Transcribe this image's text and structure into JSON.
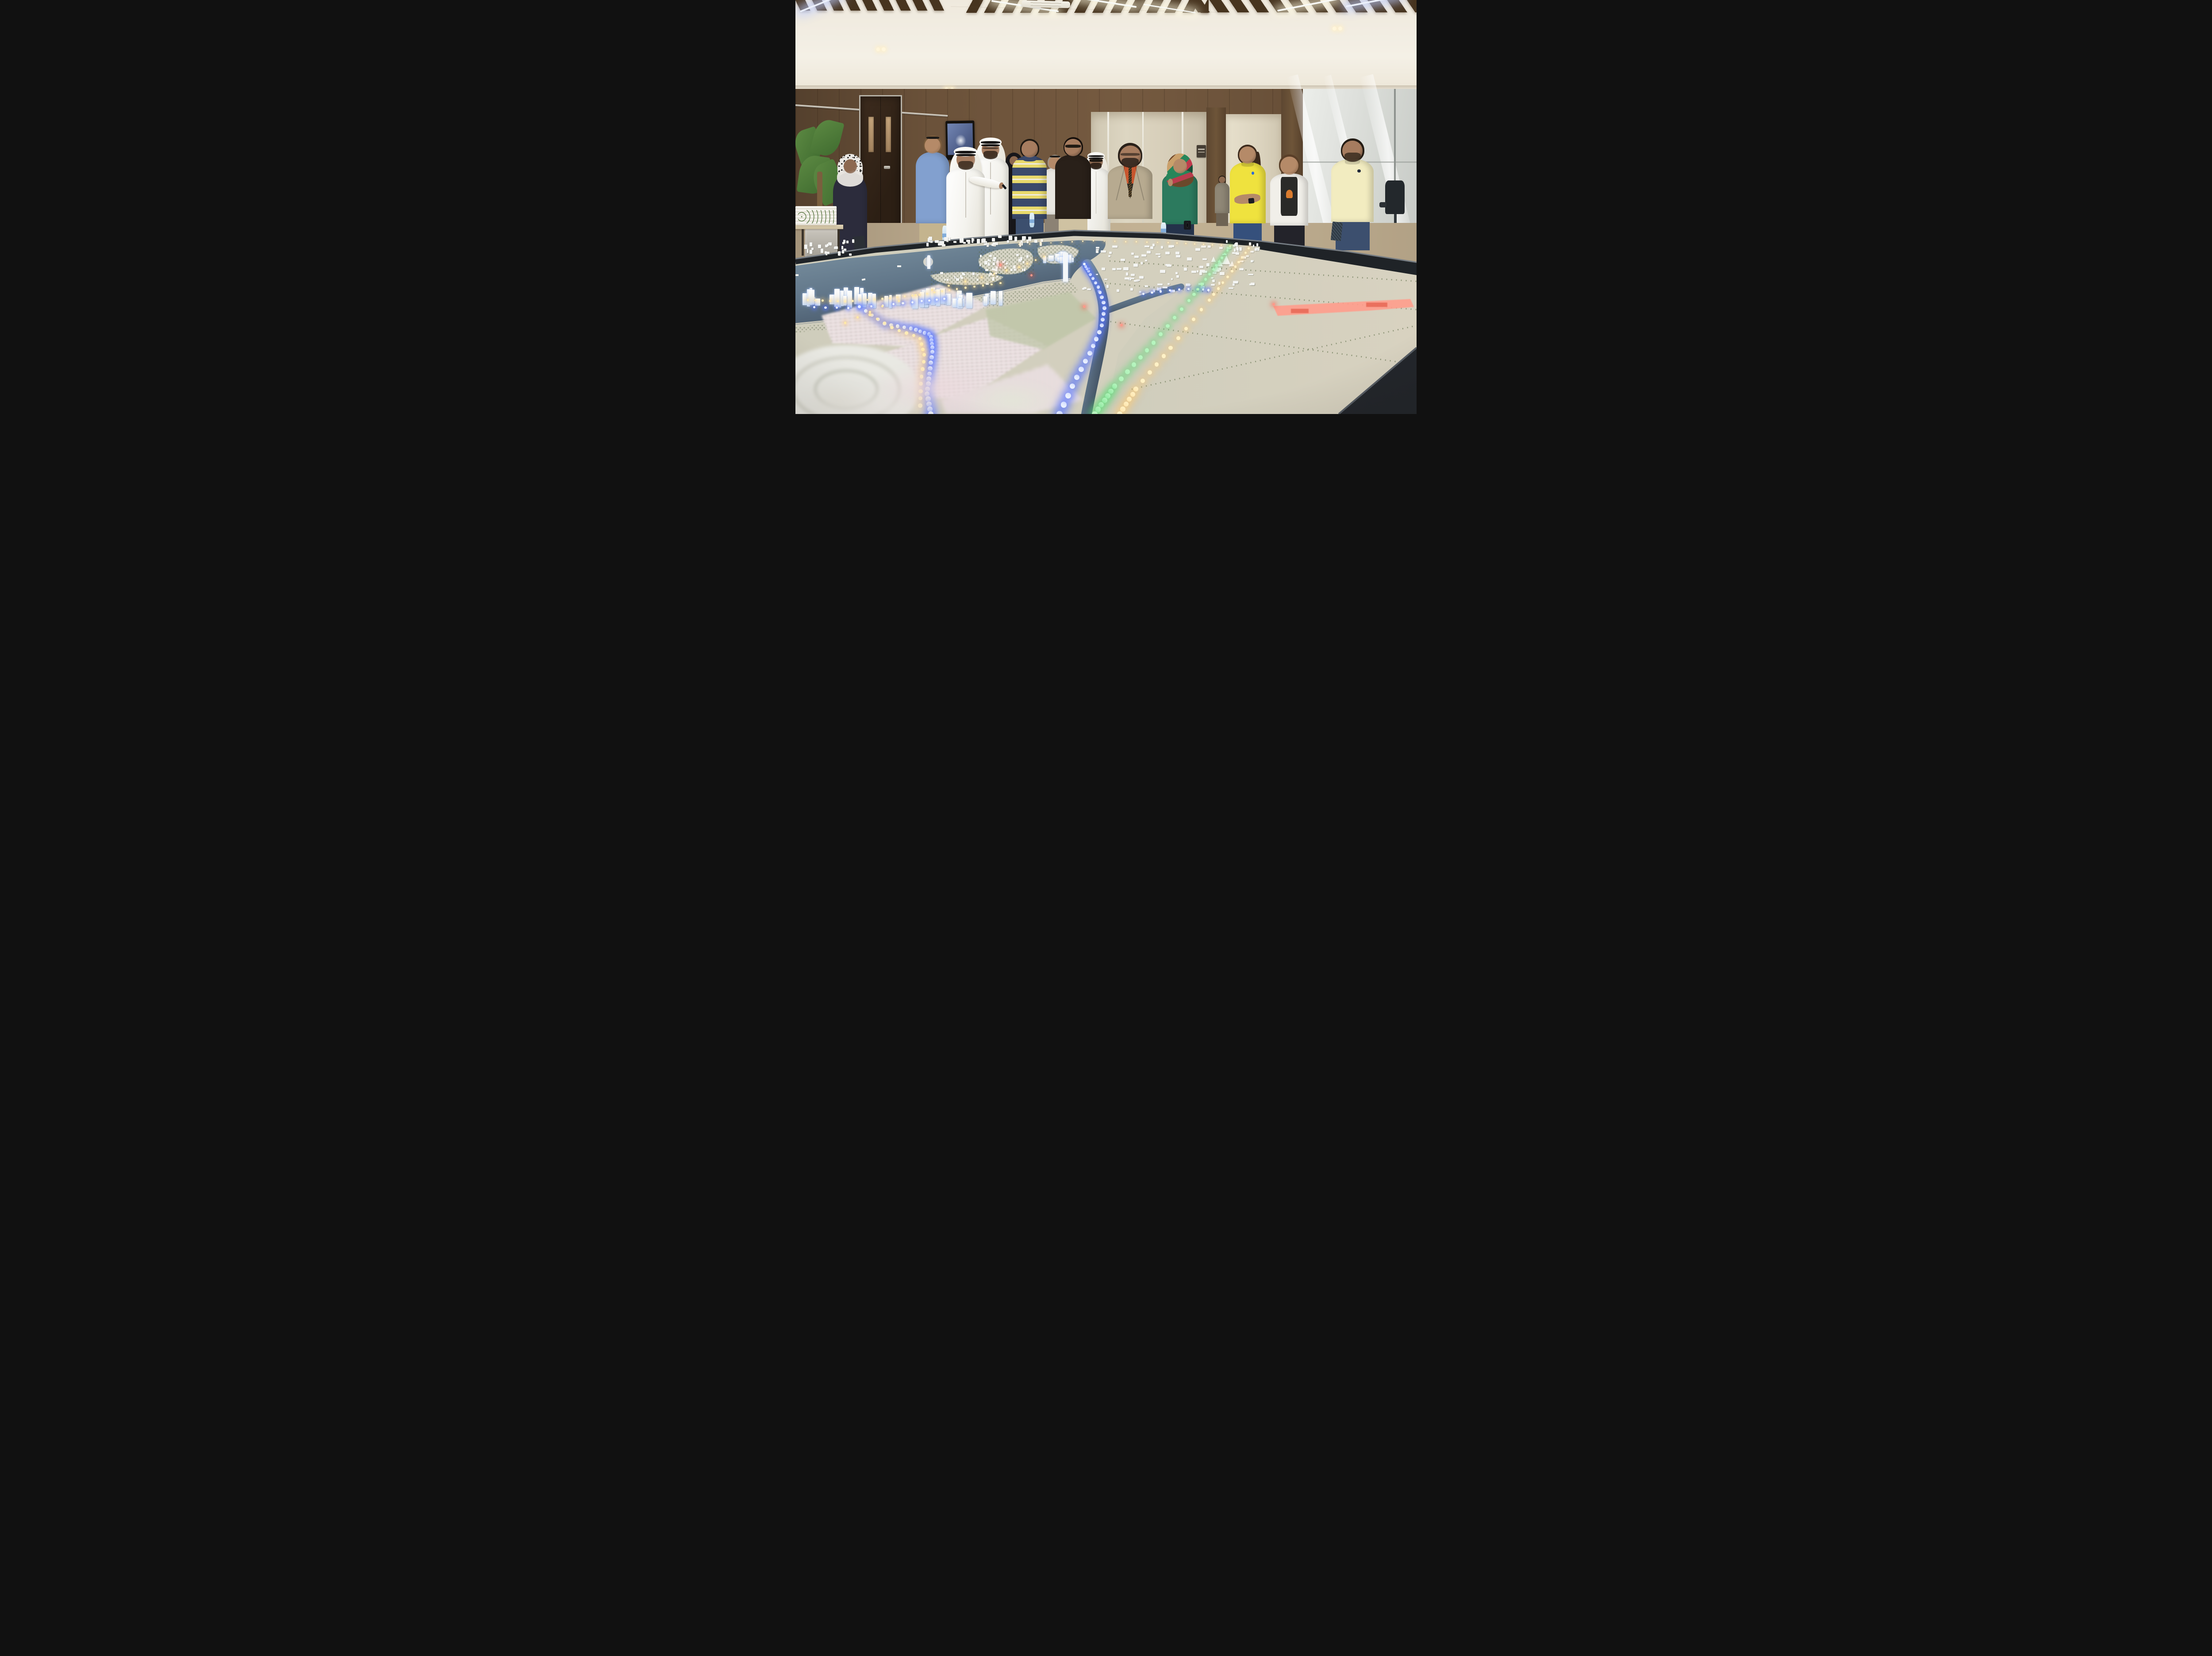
{
  "scene": {
    "label": "Showroom with visitors viewing an illuminated city masterplan scale model",
    "room": "wood-panelled hall with slatted timber ceiling, recessed strip lights, AC cassette, wall TV, double door, glass meeting room",
    "model": "large table model: sea with islands, lit tower skyline, villa districts, desert plain, LED-lit roads (blue, green, warm white), red-lit industrial strip, stadium"
  },
  "colors": {
    "ceiling": "#f1ece2",
    "beam": "#47341f",
    "wood": "#6b523a",
    "door": "#33241a",
    "chrome": "#cfc8bb",
    "floor": "#b3a384",
    "water": "#5f7487",
    "waterDeep": "#3d4b5c",
    "land": "#cfcdbc",
    "sand": "#d8d2c0",
    "treeGreen": "#5c6c49",
    "treeDark": "#46553a",
    "villaPink": "#e6d9da",
    "towerWhite": "#f3f4f2",
    "towerGlow": "#c9daf2",
    "ledBlue": "#eef4ff",
    "ledBlueRing": "rgba(90,120,255,0.85)",
    "ledGreen": "#b8f5c0",
    "ledGreenRing": "rgba(90,220,120,0.6)",
    "ledWarm": "#ffedb8",
    "ledWarmRing": "rgba(255,205,115,0.55)",
    "ledRed": "#ff9a8a",
    "ledRedRing": "rgba(255,80,60,0.5)",
    "redStrip": "#ff9d8c",
    "rim": "#1f2327",
    "thobe": "#f4f3ee",
    "ghutra": "#f8f7f3",
    "agal": "#171514"
  },
  "people": [
    {
      "id": "woman-leopard-hijab",
      "label": "woman in leopard-print hijab carrying tablet",
      "cx": 8.8,
      "top": 38.0,
      "w": 6.2,
      "h": 38,
      "z": 4,
      "skin": "#8d6950",
      "headwear": "hijab",
      "hijabStyle": "leopard",
      "topStyle": "tunic",
      "topColor": "#2c2c3c",
      "bottomColor": "#1d1d22",
      "acc": [
        {
          "type": "rect",
          "name": "tablet",
          "l": 58,
          "t": 50,
          "w": 30,
          "h": 8,
          "bg": "#2b2f35",
          "rad": "8%",
          "rot": -8
        }
      ]
    },
    {
      "id": "visitor-backpack",
      "label": "visitor with dark braid and orange-trim backpack",
      "cx": 23.3,
      "top": 40.0,
      "w": 4.6,
      "h": 20,
      "z": 3,
      "skin": "#8d6950",
      "hair": "#221b16",
      "topStyle": "shirt",
      "topColor": "#26211c",
      "bottomColor": "#26211c",
      "acc": [
        {
          "type": "rect",
          "name": "backpack",
          "l": 14,
          "t": 34,
          "w": 66,
          "h": 44,
          "bg": "linear-gradient(135deg,#1d1a18 60%,#c2571f 62%,#1d1a18 66%)",
          "rad": "22%",
          "rot": 0
        }
      ]
    },
    {
      "id": "man-blue-shirt",
      "label": "man in light blue shirt, sunglasses on head, water bottle",
      "cx": 22.1,
      "top": 33.2,
      "w": 6.0,
      "h": 28,
      "z": 4,
      "skin": "#b58a68",
      "hair": "#7a5c3c",
      "eyewear": "sunglasses-on-head",
      "topStyle": "shirt",
      "topColor": "#82a0cf",
      "bottomColor": "#c4b48e",
      "acc": [
        {
          "type": "rect",
          "name": "water-bottle",
          "l": 76,
          "t": 76,
          "w": 13,
          "h": 15,
          "bg": "linear-gradient(#e8f3fa,#b9d6e9)",
          "rad": "30%",
          "rot": 0
        }
      ]
    },
    {
      "id": "man-pointing-thobe",
      "label": "presenter in white thobe and ghutra pointing a remote",
      "cx": 27.4,
      "top": 36.3,
      "w": 7.0,
      "h": 22.5,
      "z": 5,
      "skin": "#a67c5f",
      "headwear": "ghutra",
      "beard": "#3a2c20",
      "topStyle": "thobe",
      "topColor": "#f4f3ee",
      "point": true
    },
    {
      "id": "man-glasses-thobe",
      "label": "man in white thobe and ghutra with glasses and beard",
      "cx": 31.4,
      "top": 34.0,
      "w": 6.6,
      "h": 25,
      "z": 4,
      "skin": "#a67c5f",
      "headwear": "ghutra",
      "eyewear": "glasses",
      "beard": "#33261b",
      "topStyle": "thobe",
      "topColor": "#f4f3ee"
    },
    {
      "id": "woman-abaya",
      "label": "woman in black abaya in background",
      "cx": 35.2,
      "top": 37.4,
      "w": 4.2,
      "h": 20,
      "z": 3,
      "skin": "#8d6950",
      "headwear": "hijab",
      "hijabStyle": "plain-black",
      "topStyle": "abaya",
      "topColor": "#17161a"
    },
    {
      "id": "man-striped-polo",
      "label": "man in navy-and-yellow striped polo with water bottle",
      "cx": 37.7,
      "top": 34.0,
      "w": 6.2,
      "h": 25.5,
      "z": 4,
      "skin": "#a67c5f",
      "hair": "#1f1913",
      "topStyle": "striped-polo",
      "topColor": "#e8d96b",
      "collar": "#39486b",
      "bottomColor": "#3c4f6e",
      "acc": [
        {
          "type": "rect",
          "name": "water-bottle",
          "l": 50,
          "t": 68,
          "w": 12,
          "h": 14,
          "bg": "linear-gradient(#e8f3fa,#b9d6e9)",
          "rad": "30%",
          "rot": 0
        }
      ]
    },
    {
      "id": "man-white-shirt",
      "label": "older man in white shirt in background",
      "cx": 41.8,
      "top": 37.8,
      "w": 4.8,
      "h": 19,
      "z": 3,
      "skin": "#b58a68",
      "hair": "#9d958a",
      "eyewear": "sunglasses-on-head",
      "topStyle": "shirt",
      "topColor": "#e9e7e1",
      "bottomColor": "#8c8274"
    },
    {
      "id": "man-black-shirt",
      "label": "man in dark shirt with sunglasses",
      "cx": 44.7,
      "top": 33.6,
      "w": 6.4,
      "h": 26,
      "z": 4,
      "skin": "#a67c5f",
      "hair": "#16100c",
      "eyewear": "sunglasses",
      "topStyle": "shirt",
      "topColor": "#292019",
      "bottomColor": "#cfc2a2"
    },
    {
      "id": "man-thobe-background",
      "label": "man in thobe with dark sunglasses in background",
      "cx": 48.4,
      "top": 37.4,
      "w": 5.2,
      "h": 20,
      "z": 3,
      "skin": "#8d6950",
      "headwear": "ghutra",
      "eyewear": "sunglasses",
      "beard": "#241a12",
      "topStyle": "thobe",
      "topColor": "#efeee8"
    },
    {
      "id": "man-gray-suit",
      "label": "smiling man in gray suit, orange shirt and patterned tie",
      "cx": 53.9,
      "top": 35.1,
      "w": 8.0,
      "h": 24,
      "z": 4,
      "skin": "#a67c5f",
      "hair": "#2a211a",
      "eyewear": "glasses",
      "beard": "#2a211a",
      "topStyle": "suit",
      "topColor": "#b7aa90",
      "shirtColor": "#c8562e",
      "tieColor": "#2f261c"
    },
    {
      "id": "woman-green-hijab",
      "label": "woman in green blouse and multicolour hijab holding phone to chin",
      "cx": 61.9,
      "top": 37.9,
      "w": 6.4,
      "h": 22,
      "z": 4,
      "skin": "#b58a68",
      "headwear": "hijab",
      "hijabStyle": "multi",
      "topStyle": "shirt",
      "topColor": "#2c7a5e",
      "bottomColor": "#24324a",
      "acc": [
        {
          "type": "rect",
          "name": "water-bottle",
          "l": 2,
          "t": 72,
          "w": 13,
          "h": 15,
          "bg": "linear-gradient(#e8f3fa,#b9d6e9)",
          "rad": "30%",
          "rot": 0
        },
        {
          "type": "rect",
          "name": "camera",
          "l": 60,
          "t": 70,
          "w": 18,
          "h": 10,
          "bg": "#17181c",
          "rad": "15%",
          "rot": 0
        },
        {
          "type": "circle",
          "name": "raised-hand",
          "l": 20,
          "t": 24,
          "w": 12,
          "h": 8,
          "bg": "#b58a68"
        }
      ]
    },
    {
      "id": "person-far-corridor",
      "label": "person in far corridor",
      "cx": 68.7,
      "top": 42.6,
      "w": 2.6,
      "h": 12,
      "z": 2,
      "skin": "#8d6950",
      "hair": "#241c14",
      "topStyle": "shirt",
      "topColor": "#8f8776",
      "bottomColor": "#6e6354"
    },
    {
      "id": "woman-yellow-polo",
      "label": "woman in bright yellow polo with arms crossed",
      "cx": 72.8,
      "top": 35.4,
      "w": 6.4,
      "h": 25,
      "z": 4,
      "skin": "#b58a68",
      "hair": "#3c2a1c",
      "hairStyle": "ponytail",
      "topStyle": "polo",
      "topColor": "#efe23e",
      "logo": "#2d6bd8",
      "bottomColor": "#35507c",
      "acc": [
        {
          "type": "rect",
          "name": "crossed-forearm",
          "l": 16,
          "t": 46,
          "w": 66,
          "h": 9,
          "bg": "#b58a68",
          "rad": "40%",
          "rot": -6
        },
        {
          "type": "rect",
          "name": "phone",
          "l": 52,
          "t": 50,
          "w": 14,
          "h": 5,
          "bg": "#1b1d22",
          "rad": "20%",
          "rot": -6
        }
      ]
    },
    {
      "id": "woman-white-cardigan",
      "label": "woman in white cardigan over butterfly-print top",
      "cx": 79.5,
      "top": 37.8,
      "w": 6.8,
      "h": 22.5,
      "z": 4,
      "skin": "#b58a68",
      "hair": "#5a3f28",
      "topStyle": "cardigan",
      "topColor": "#f1efe9",
      "teeColor": "#2a2a28",
      "accentColor": "#d97b2e",
      "bottomColor": "#23232a"
    },
    {
      "id": "man-yellow-polo",
      "label": "man in pale yellow polo holding a notebook",
      "cx": 89.7,
      "top": 34.0,
      "w": 7.6,
      "h": 26.5,
      "z": 4,
      "skin": "#a67c5f",
      "hair": "#241c14",
      "beard": "#3a2d20",
      "topStyle": "polo",
      "topColor": "#f2ecc0",
      "logo": "#222a3a",
      "bottomColor": "#3c4f6e",
      "acc": [
        {
          "type": "rect",
          "name": "notebook",
          "l": 6,
          "t": 74,
          "w": 22,
          "h": 17,
          "bg": "repeating-linear-gradient(45deg,#2f3a44 0 3px,#44525e 3px 5px)",
          "rad": "6%",
          "rot": 6
        }
      ]
    }
  ],
  "model": {
    "clusters": [
      {
        "id": "far-left-village",
        "x": 0.5,
        "y": 57.8,
        "w": 9,
        "h": 4,
        "count": 24,
        "wMin": 0.25,
        "wMax": 0.6,
        "hMin": 0.5,
        "hMax": 1.1,
        "stand": false,
        "glow": false
      },
      {
        "id": "far-shore-blocks",
        "x": 21,
        "y": 56.8,
        "w": 19,
        "h": 2.8,
        "count": 40,
        "wMin": 0.25,
        "wMax": 0.65,
        "hMin": 0.45,
        "hMax": 1.2,
        "stand": false,
        "glow": false
      },
      {
        "id": "center-island-houses",
        "x": 29.5,
        "y": 61.2,
        "w": 8.5,
        "h": 4.4,
        "count": 34,
        "wMin": 0.22,
        "wMax": 0.5,
        "hMin": 0.35,
        "hMax": 0.8,
        "stand": false,
        "glow": false
      },
      {
        "id": "crescent-island-houses",
        "x": 22,
        "y": 65.6,
        "w": 11.5,
        "h": 2.4,
        "count": 22,
        "wMin": 0.22,
        "wMax": 0.5,
        "hMin": 0.35,
        "hMax": 0.7,
        "stand": false,
        "glow": false
      },
      {
        "id": "right-island-towers",
        "x": 39,
        "y": 59.6,
        "w": 6,
        "h": 4,
        "count": 12,
        "wMin": 0.45,
        "wMax": 0.9,
        "hMin": 1.0,
        "hMax": 2.2,
        "stand": true,
        "glow": true
      },
      {
        "id": "waterfront-skyline",
        "x": 1,
        "y": 68.4,
        "w": 32.5,
        "h": 6.2,
        "count": 48,
        "wMin": 0.45,
        "wMax": 1.0,
        "hMin": 1.6,
        "hMax": 4.4,
        "stand": true,
        "glow": true
      },
      {
        "id": "central-district",
        "x": 46,
        "y": 58.8,
        "w": 28,
        "h": 12,
        "count": 110,
        "wMin": 0.3,
        "wMax": 0.85,
        "hMin": 0.35,
        "hMax": 0.8,
        "stand": false,
        "glow": false
      },
      {
        "id": "right-village",
        "x": 69.3,
        "y": 58.0,
        "w": 5.5,
        "h": 3.2,
        "count": 16,
        "wMin": 0.25,
        "wMax": 0.6,
        "hMin": 0.4,
        "hMax": 0.9,
        "stand": false,
        "glow": false
      }
    ],
    "landmarks": [
      {
        "id": "landmark-tower",
        "x": 21.2,
        "y": 61.6,
        "w": 0.55,
        "h": 3.4
      },
      {
        "id": "cylinder-tower",
        "x": 43.1,
        "y": 60.9,
        "w": 0.8,
        "h": 7.2
      }
    ],
    "tents": [
      [
        66.8,
        61.8
      ],
      [
        67.8,
        62.6
      ],
      [
        68.9,
        61.9
      ],
      [
        69.8,
        62.8
      ],
      [
        67.3,
        63.9
      ]
    ],
    "leds": [
      {
        "id": "shore-warm",
        "color": "#ffedb8",
        "ring": "rgba(255,205,115,0.55)",
        "points": [
          [
            2,
            72.5
          ],
          [
            8,
            72.8
          ],
          [
            14,
            72.2
          ],
          [
            20,
            71.2
          ],
          [
            26,
            69.8
          ],
          [
            33,
            68.4
          ]
        ],
        "count": 26,
        "sMin": 0.28,
        "sMax": 0.42
      },
      {
        "id": "shore-blue",
        "color": "#eef4ff",
        "ring": "rgba(90,120,255,0.85)",
        "points": [
          [
            3,
            74.2
          ],
          [
            9,
            74.4
          ],
          [
            15,
            73.6
          ],
          [
            20,
            72.8
          ],
          [
            24,
            72.2
          ]
        ],
        "count": 14,
        "sMin": 0.3,
        "sMax": 0.45
      },
      {
        "id": "road-blue-left",
        "color": "#eef4ff",
        "ring": "rgba(90,120,255,0.85)",
        "points": [
          [
            10.3,
            74.1
          ],
          [
            14.5,
            78.3
          ],
          [
            18.9,
            79.4
          ],
          [
            21.8,
            80.9
          ],
          [
            22.1,
            84.4
          ],
          [
            21.6,
            89.9
          ],
          [
            21.2,
            95.0
          ],
          [
            21.8,
            100
          ]
        ],
        "count": 30,
        "sMin": 0.32,
        "sMax": 0.85
      },
      {
        "id": "road-warm-left",
        "color": "#ffedb8",
        "ring": "rgba(255,205,115,0.5)",
        "points": [
          [
            12,
            76
          ],
          [
            16,
            79.5
          ],
          [
            20,
            81.5
          ],
          [
            20.8,
            86
          ],
          [
            20.2,
            92
          ],
          [
            20.1,
            98
          ]
        ],
        "count": 18,
        "sMin": 0.3,
        "sMax": 0.7
      },
      {
        "id": "canal-blue",
        "color": "#eef4ff",
        "ring": "rgba(90,120,255,0.85)",
        "points": [
          [
            42.5,
            100
          ],
          [
            45,
            92
          ],
          [
            47.5,
            85
          ],
          [
            49.3,
            79
          ],
          [
            49.8,
            74
          ],
          [
            48.8,
            69.5
          ],
          [
            47.3,
            65.8
          ],
          [
            46.5,
            63.8
          ]
        ],
        "count": 26,
        "sMin": 0.34,
        "sMax": 1.0
      },
      {
        "id": "metro-blue-east",
        "color": "#eef4ff",
        "ring": "rgba(90,120,255,0.8)",
        "points": [
          [
            56,
            71
          ],
          [
            58.8,
            70.4
          ],
          [
            61.8,
            69.9
          ],
          [
            64.8,
            69.8
          ],
          [
            66.5,
            70.1
          ]
        ],
        "count": 9,
        "sMin": 0.32,
        "sMax": 0.5
      },
      {
        "id": "road-green",
        "color": "#b8f5c0",
        "ring": "rgba(90,220,120,0.6)",
        "points": [
          [
            70,
            59.6
          ],
          [
            67.4,
            64.8
          ],
          [
            63.8,
            71.8
          ],
          [
            57.2,
            83.6
          ],
          [
            51.2,
            93.6
          ],
          [
            48.2,
            100
          ]
        ],
        "count": 30,
        "sMin": 0.3,
        "sMax": 0.9
      },
      {
        "id": "road-warm-right",
        "color": "#fff2c8",
        "ring": "rgba(255,205,115,0.5)",
        "points": [
          [
            73,
            60
          ],
          [
            70.3,
            65.5
          ],
          [
            66.6,
            72.5
          ],
          [
            60.4,
            84
          ],
          [
            54.8,
            94
          ],
          [
            52.2,
            100
          ]
        ],
        "count": 26,
        "sMin": 0.3,
        "sMax": 0.85
      },
      {
        "id": "desert-road-warm",
        "color": "#fff0c0",
        "ring": "rgba(255,200,110,0.4)",
        "points": [
          [
            36,
            59
          ],
          [
            48,
            58.2
          ],
          [
            60,
            58.6
          ],
          [
            70,
            59.4
          ]
        ],
        "count": 22,
        "sMin": 0.2,
        "sMax": 0.3
      },
      {
        "id": "villa-lights",
        "color": "#ffe9a8",
        "ring": "rgba(255,190,90,0.45)",
        "points": [
          [
            8,
            78
          ],
          [
            14,
            74
          ],
          [
            22,
            70
          ],
          [
            30,
            67
          ],
          [
            36,
            64.5
          ],
          [
            40,
            62
          ]
        ],
        "count": 16,
        "sMin": 0.25,
        "sMax": 0.5
      },
      {
        "id": "red-glows",
        "color": "#ff9a8a",
        "ring": "rgba(255,80,60,0.5)",
        "points": [
          [
            33,
            64
          ],
          [
            38,
            66.5
          ],
          [
            46.5,
            74
          ],
          [
            52.5,
            78.5
          ],
          [
            77,
            73.5
          ]
        ],
        "count": 5,
        "sMin": 0.35,
        "sMax": 0.5
      }
    ]
  }
}
